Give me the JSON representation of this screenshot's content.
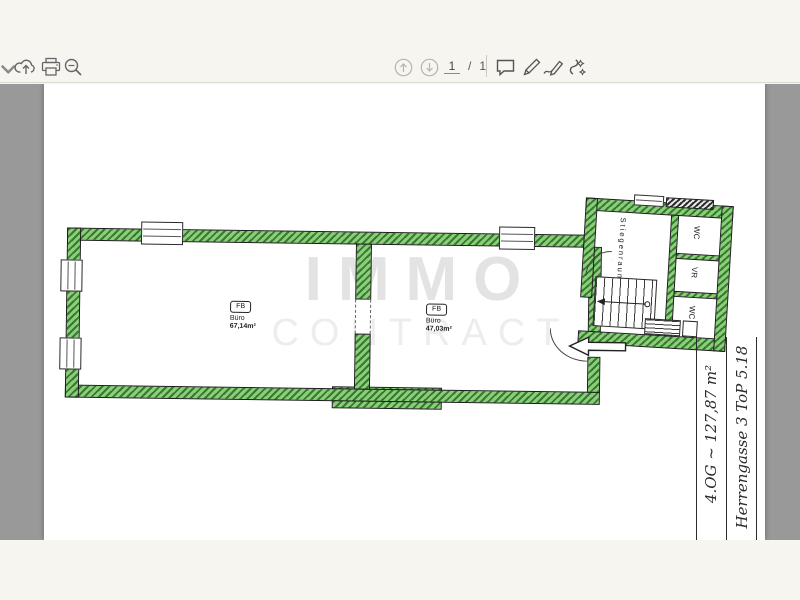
{
  "colors": {
    "toolbar_background": "#f7f5ef",
    "viewer_background": "#999999",
    "page_background": "#ffffff",
    "wall_hatch_dark": "#2f7d33",
    "wall_hatch_light": "#90cc78",
    "watermark_grey": "#e3e3e3"
  },
  "toolbar": {
    "left_icons": [
      "overflow-caret",
      "download",
      "print",
      "zoom-out"
    ],
    "pager": {
      "current_page": "1",
      "separator": "/",
      "total_pages": "1"
    },
    "right_icons": [
      "comment",
      "pen",
      "signature",
      "draw"
    ]
  },
  "floorplan": {
    "watermark": {
      "line1": "IMMO",
      "line2": "CONTRACT"
    },
    "rooms": [
      {
        "tag": "FB",
        "name": "Büro",
        "area": "67,14m²"
      },
      {
        "tag": "FB",
        "name": "Büro",
        "area": "47,03m²"
      }
    ],
    "stairwell": {
      "label": "Stiegenraum",
      "room_top": "WC",
      "room_middle": "VR",
      "room_bottom": "WC"
    },
    "annotation": {
      "line1": "Herrengasse 3 ToP 5.18",
      "line2": "4.OG ~ 127,87 m²"
    }
  }
}
